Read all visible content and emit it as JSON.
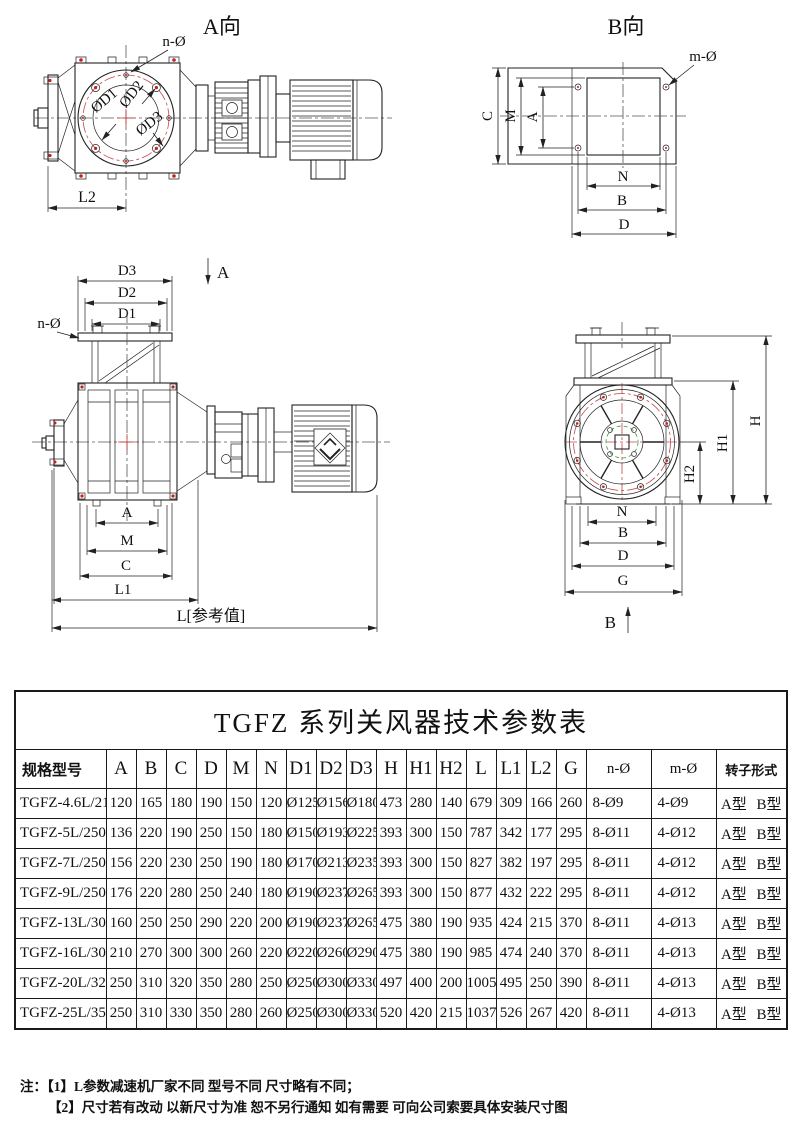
{
  "drawing_labels": {
    "av_title": "A向",
    "bv_title": "B向",
    "n_hole": "n-Ø",
    "m_hole": "m-Ø",
    "dd1": "ØD1",
    "dd2": "ØD2",
    "dd3": "ØD3",
    "l2": "L2",
    "c": "C",
    "m": "M",
    "a": "A",
    "n": "N",
    "b": "B",
    "d": "D",
    "g": "G",
    "d1": "D1",
    "d2": "D2",
    "d3": "D3",
    "l1": "L1",
    "l_ref": "L[参考值]",
    "h": "H",
    "h1": "H1",
    "h2": "H2"
  },
  "table": {
    "title": "TGFZ 系列关风器技术参数表",
    "headers": [
      "规格型号",
      "A",
      "B",
      "C",
      "D",
      "M",
      "N",
      "D1",
      "D2",
      "D3",
      "H",
      "H1",
      "H2",
      "L",
      "L1",
      "L2",
      "G",
      "n-Ø",
      "m-Ø",
      "转子形式"
    ],
    "rows": [
      [
        "TGFZ-4.6L/210",
        "120",
        "165",
        "180",
        "190",
        "150",
        "120",
        "Ø125",
        "Ø156",
        "Ø180",
        "473",
        "280",
        "140",
        "679",
        "309",
        "166",
        "260",
        "8-Ø9",
        "4-Ø9",
        "A型 B型"
      ],
      [
        "TGFZ-5L/250",
        "136",
        "220",
        "190",
        "250",
        "150",
        "180",
        "Ø150",
        "Ø193",
        "Ø225",
        "393",
        "300",
        "150",
        "787",
        "342",
        "177",
        "295",
        "8-Ø11",
        "4-Ø12",
        "A型 B型"
      ],
      [
        "TGFZ-7L/250",
        "156",
        "220",
        "230",
        "250",
        "190",
        "180",
        "Ø170",
        "Ø213",
        "Ø235",
        "393",
        "300",
        "150",
        "827",
        "382",
        "197",
        "295",
        "8-Ø11",
        "4-Ø12",
        "A型 B型"
      ],
      [
        "TGFZ-9L/250",
        "176",
        "220",
        "280",
        "250",
        "240",
        "180",
        "Ø190",
        "Ø237",
        "Ø265",
        "393",
        "300",
        "150",
        "877",
        "432",
        "222",
        "295",
        "8-Ø11",
        "4-Ø12",
        "A型 B型"
      ],
      [
        "TGFZ-13L/300",
        "160",
        "250",
        "250",
        "290",
        "220",
        "200",
        "Ø190",
        "Ø237",
        "Ø265",
        "475",
        "380",
        "190",
        "935",
        "424",
        "215",
        "370",
        "8-Ø11",
        "4-Ø13",
        "A型 B型"
      ],
      [
        "TGFZ-16L/300",
        "210",
        "270",
        "300",
        "300",
        "260",
        "220",
        "Ø220",
        "Ø260",
        "Ø290",
        "475",
        "380",
        "190",
        "985",
        "474",
        "240",
        "370",
        "8-Ø11",
        "4-Ø13",
        "A型 B型"
      ],
      [
        "TGFZ-20L/320",
        "250",
        "310",
        "320",
        "350",
        "280",
        "250",
        "Ø250",
        "Ø300",
        "Ø330",
        "497",
        "400",
        "200",
        "1005",
        "495",
        "250",
        "390",
        "8-Ø11",
        "4-Ø13",
        "A型 B型"
      ],
      [
        "TGFZ-25L/350",
        "250",
        "310",
        "330",
        "350",
        "280",
        "260",
        "Ø250",
        "Ø300",
        "Ø330",
        "520",
        "420",
        "215",
        "1037",
        "526",
        "267",
        "420",
        "8-Ø11",
        "4-Ø13",
        "A型 B型"
      ]
    ]
  },
  "notes": {
    "prefix": "注：",
    "items": [
      "【1】L参数减速机厂家不同  型号不同  尺寸略有不同；",
      "【2】尺寸若有改动  以新尺寸为准  恕不另行通知  如有需要  可向公司索要具体安装尺寸图"
    ]
  },
  "colors": {
    "line": "#222222",
    "accent_red": "#c23a3a",
    "accent_green": "#3a9a3a",
    "background": "#ffffff"
  }
}
